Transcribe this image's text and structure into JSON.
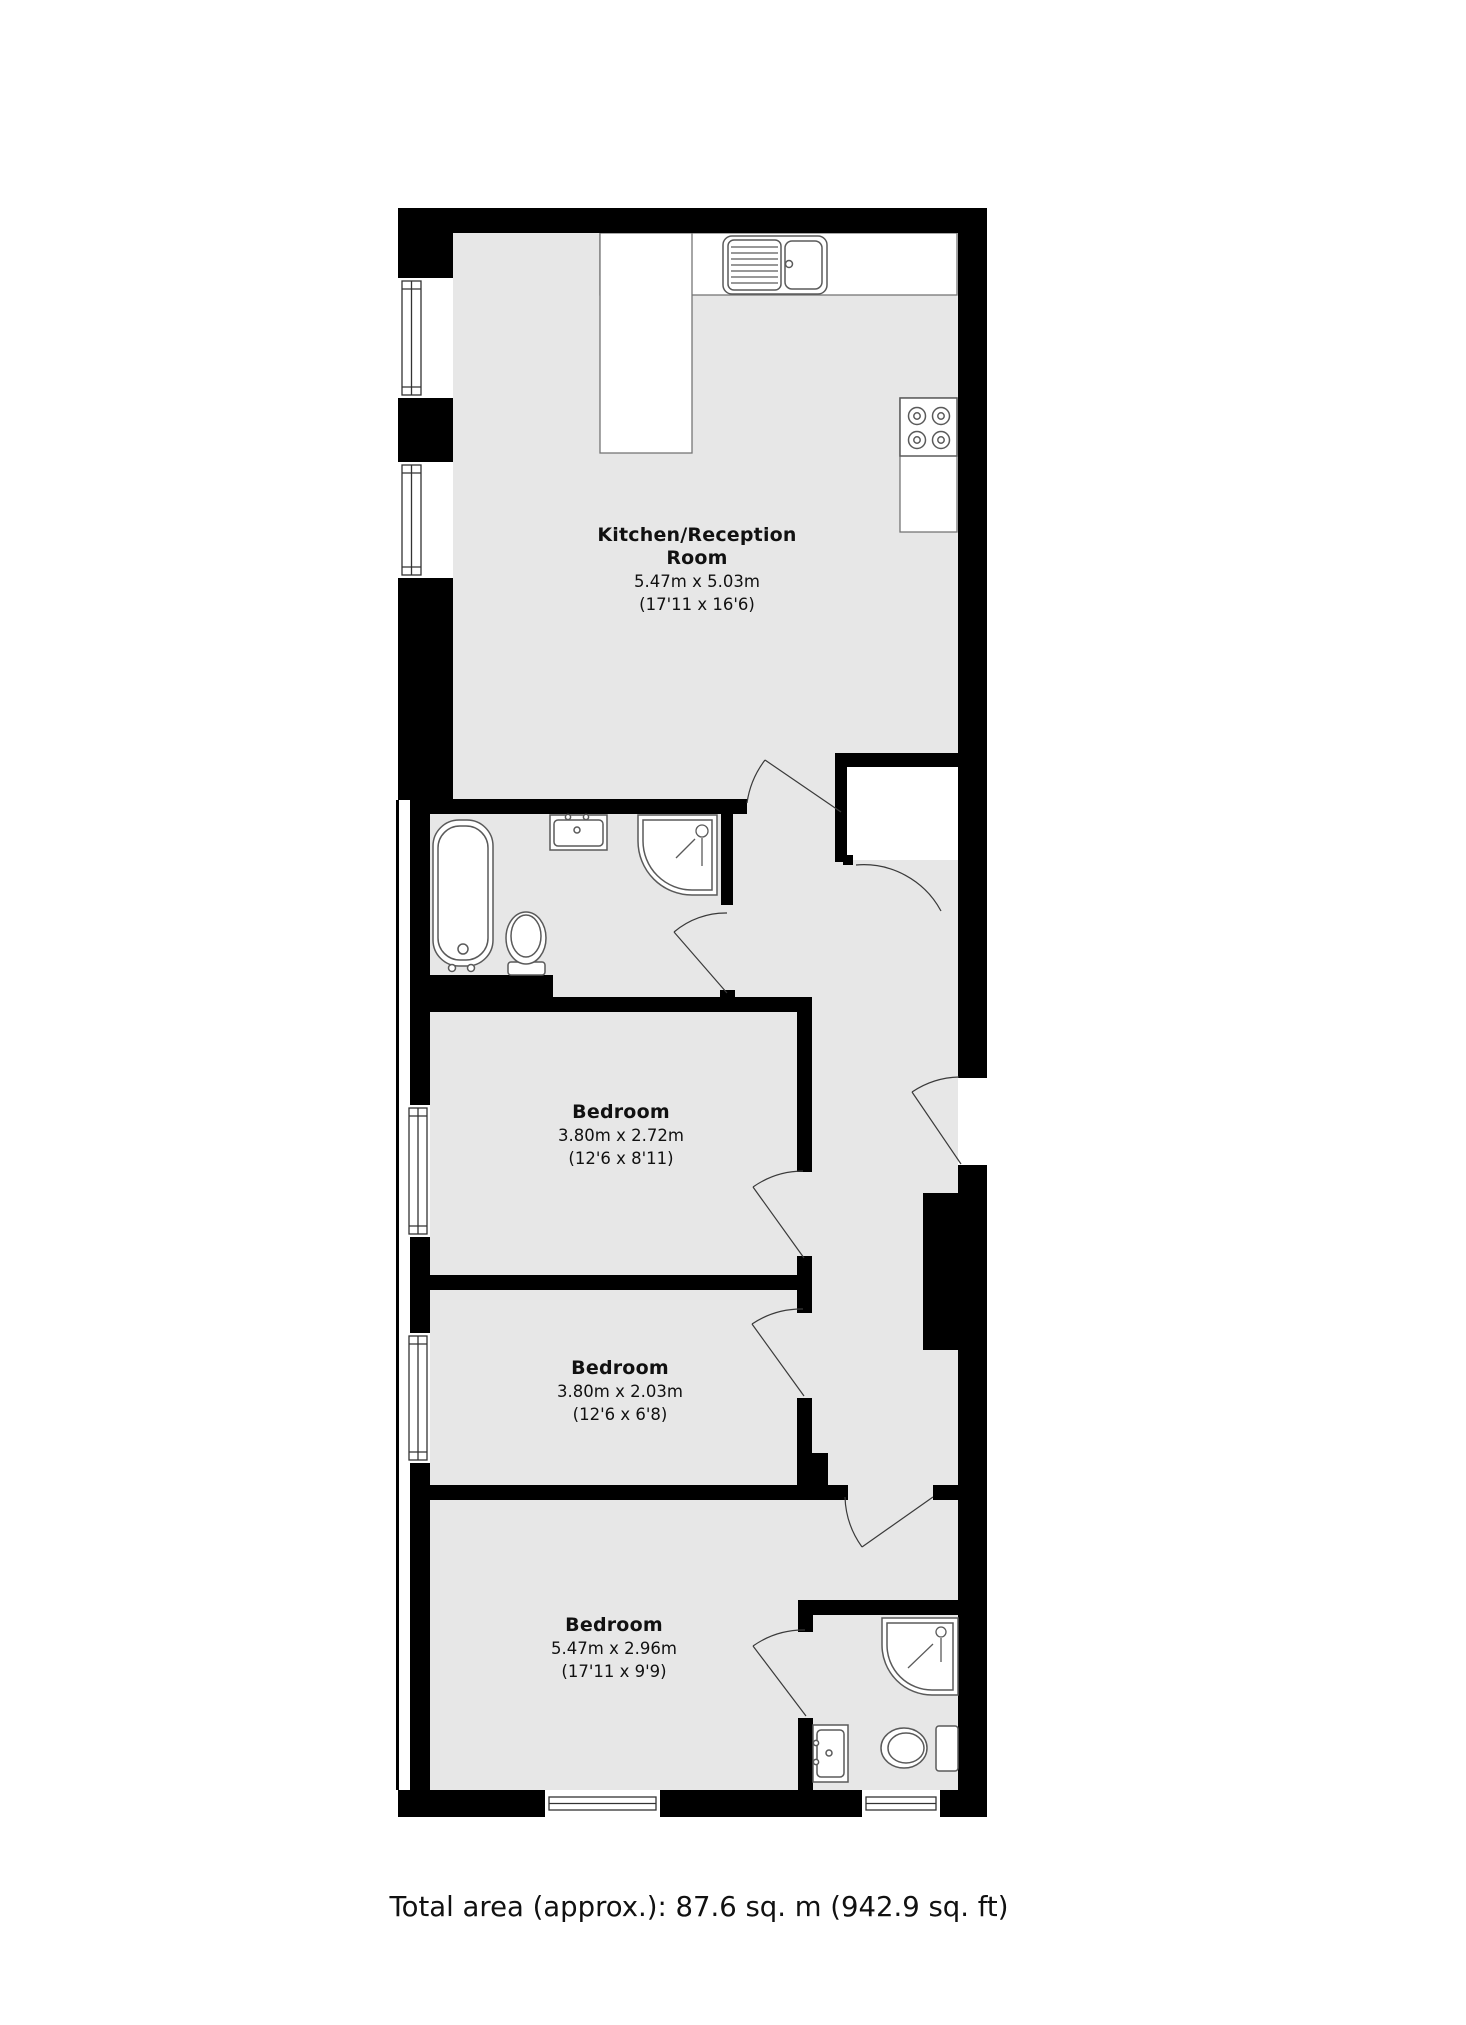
{
  "floorplan": {
    "rooms": [
      {
        "name": "Kitchen/Reception Room",
        "metric": "5.47m x 5.03m",
        "imperial": "(17'11 x 16'6)"
      },
      {
        "name": "Bedroom",
        "metric": "3.80m x 2.72m",
        "imperial": "(12'6 x 8'11)"
      },
      {
        "name": "Bedroom",
        "metric": "3.80m x 2.03m",
        "imperial": "(12'6 x 6'8)"
      },
      {
        "name": "Bedroom",
        "metric": "5.47m x 2.96m",
        "imperial": "(17'11 x 9'9)"
      }
    ],
    "total_area": "Total area (approx.): 87.6 sq. m (942.9 sq. ft)",
    "colors": {
      "wall": "#000000",
      "floor": "#e7e7e7",
      "fixture_outline": "#5a5a5a",
      "counter_line": "#757575",
      "door_line": "#3a3a3a",
      "text": "#111111",
      "background": "#ffffff"
    }
  }
}
